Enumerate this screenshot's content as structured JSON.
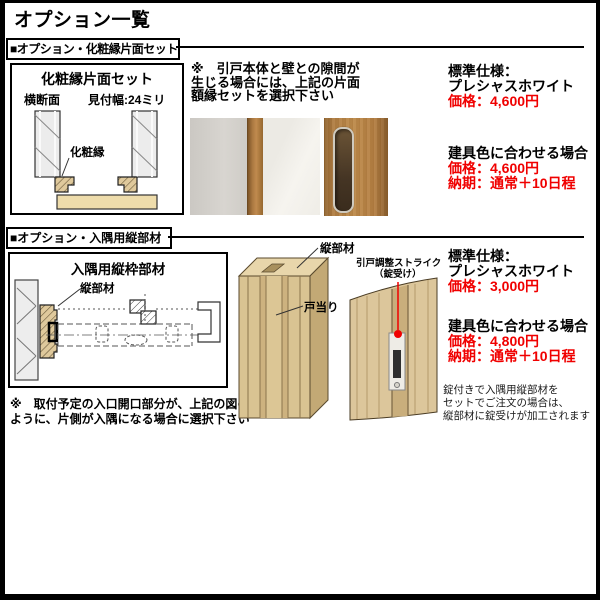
{
  "title": "オプション一覧",
  "colors": {
    "price_red": "#f00000",
    "wood_tan": "#dcc69b",
    "door_brown": "#b07d42"
  },
  "section1": {
    "header": "■オプション・化粧縁片面セット",
    "diagram": {
      "title": "化粧縁片面セット",
      "cross_section_label": "横断面",
      "width_label": "見付幅:24ミリ",
      "edge_label": "化粧縁"
    },
    "note": {
      "line1": "※　引戸本体と壁との隙間が",
      "line2": "生じる場合には、上記の片面",
      "line3": "額縁セットを選択下さい"
    },
    "pricing": {
      "standard_title": "標準仕様：",
      "standard_spec": "プレシャスホワイト",
      "standard_price": "価格：4,600円",
      "custom_title": "建具色に合わせる場合",
      "custom_price": "価格：4,600円",
      "custom_lead_time": "納期：通常＋10日程"
    }
  },
  "section2": {
    "header": "■オプション・入隅用縦部材",
    "diagram": {
      "title": "入隅用縦枠部材",
      "member_label": "縦部材"
    },
    "note": {
      "line1": "※　取付予定の入口開口部分が、上記の図の",
      "line2": "ように、片側が入隅になる場合に選択下さい"
    },
    "illustration": {
      "member_label": "縦部材",
      "doorstop_label": "戸当り",
      "strike_label_line1": "引戸調整ストライク",
      "strike_label_line2": "（錠受け）"
    },
    "pricing": {
      "standard_title": "標準仕様：",
      "standard_spec": "プレシャスホワイト",
      "standard_price": "価格：3,000円",
      "custom_title": "建具色に合わせる場合",
      "custom_price": "価格：4,800円",
      "custom_lead_time": "納期：通常＋10日程"
    },
    "lock_note": {
      "line1": "錠付きで入隅用縦部材を",
      "line2": "セットでご注文の場合は、",
      "line3": "縦部材に錠受けが加工されます"
    }
  }
}
